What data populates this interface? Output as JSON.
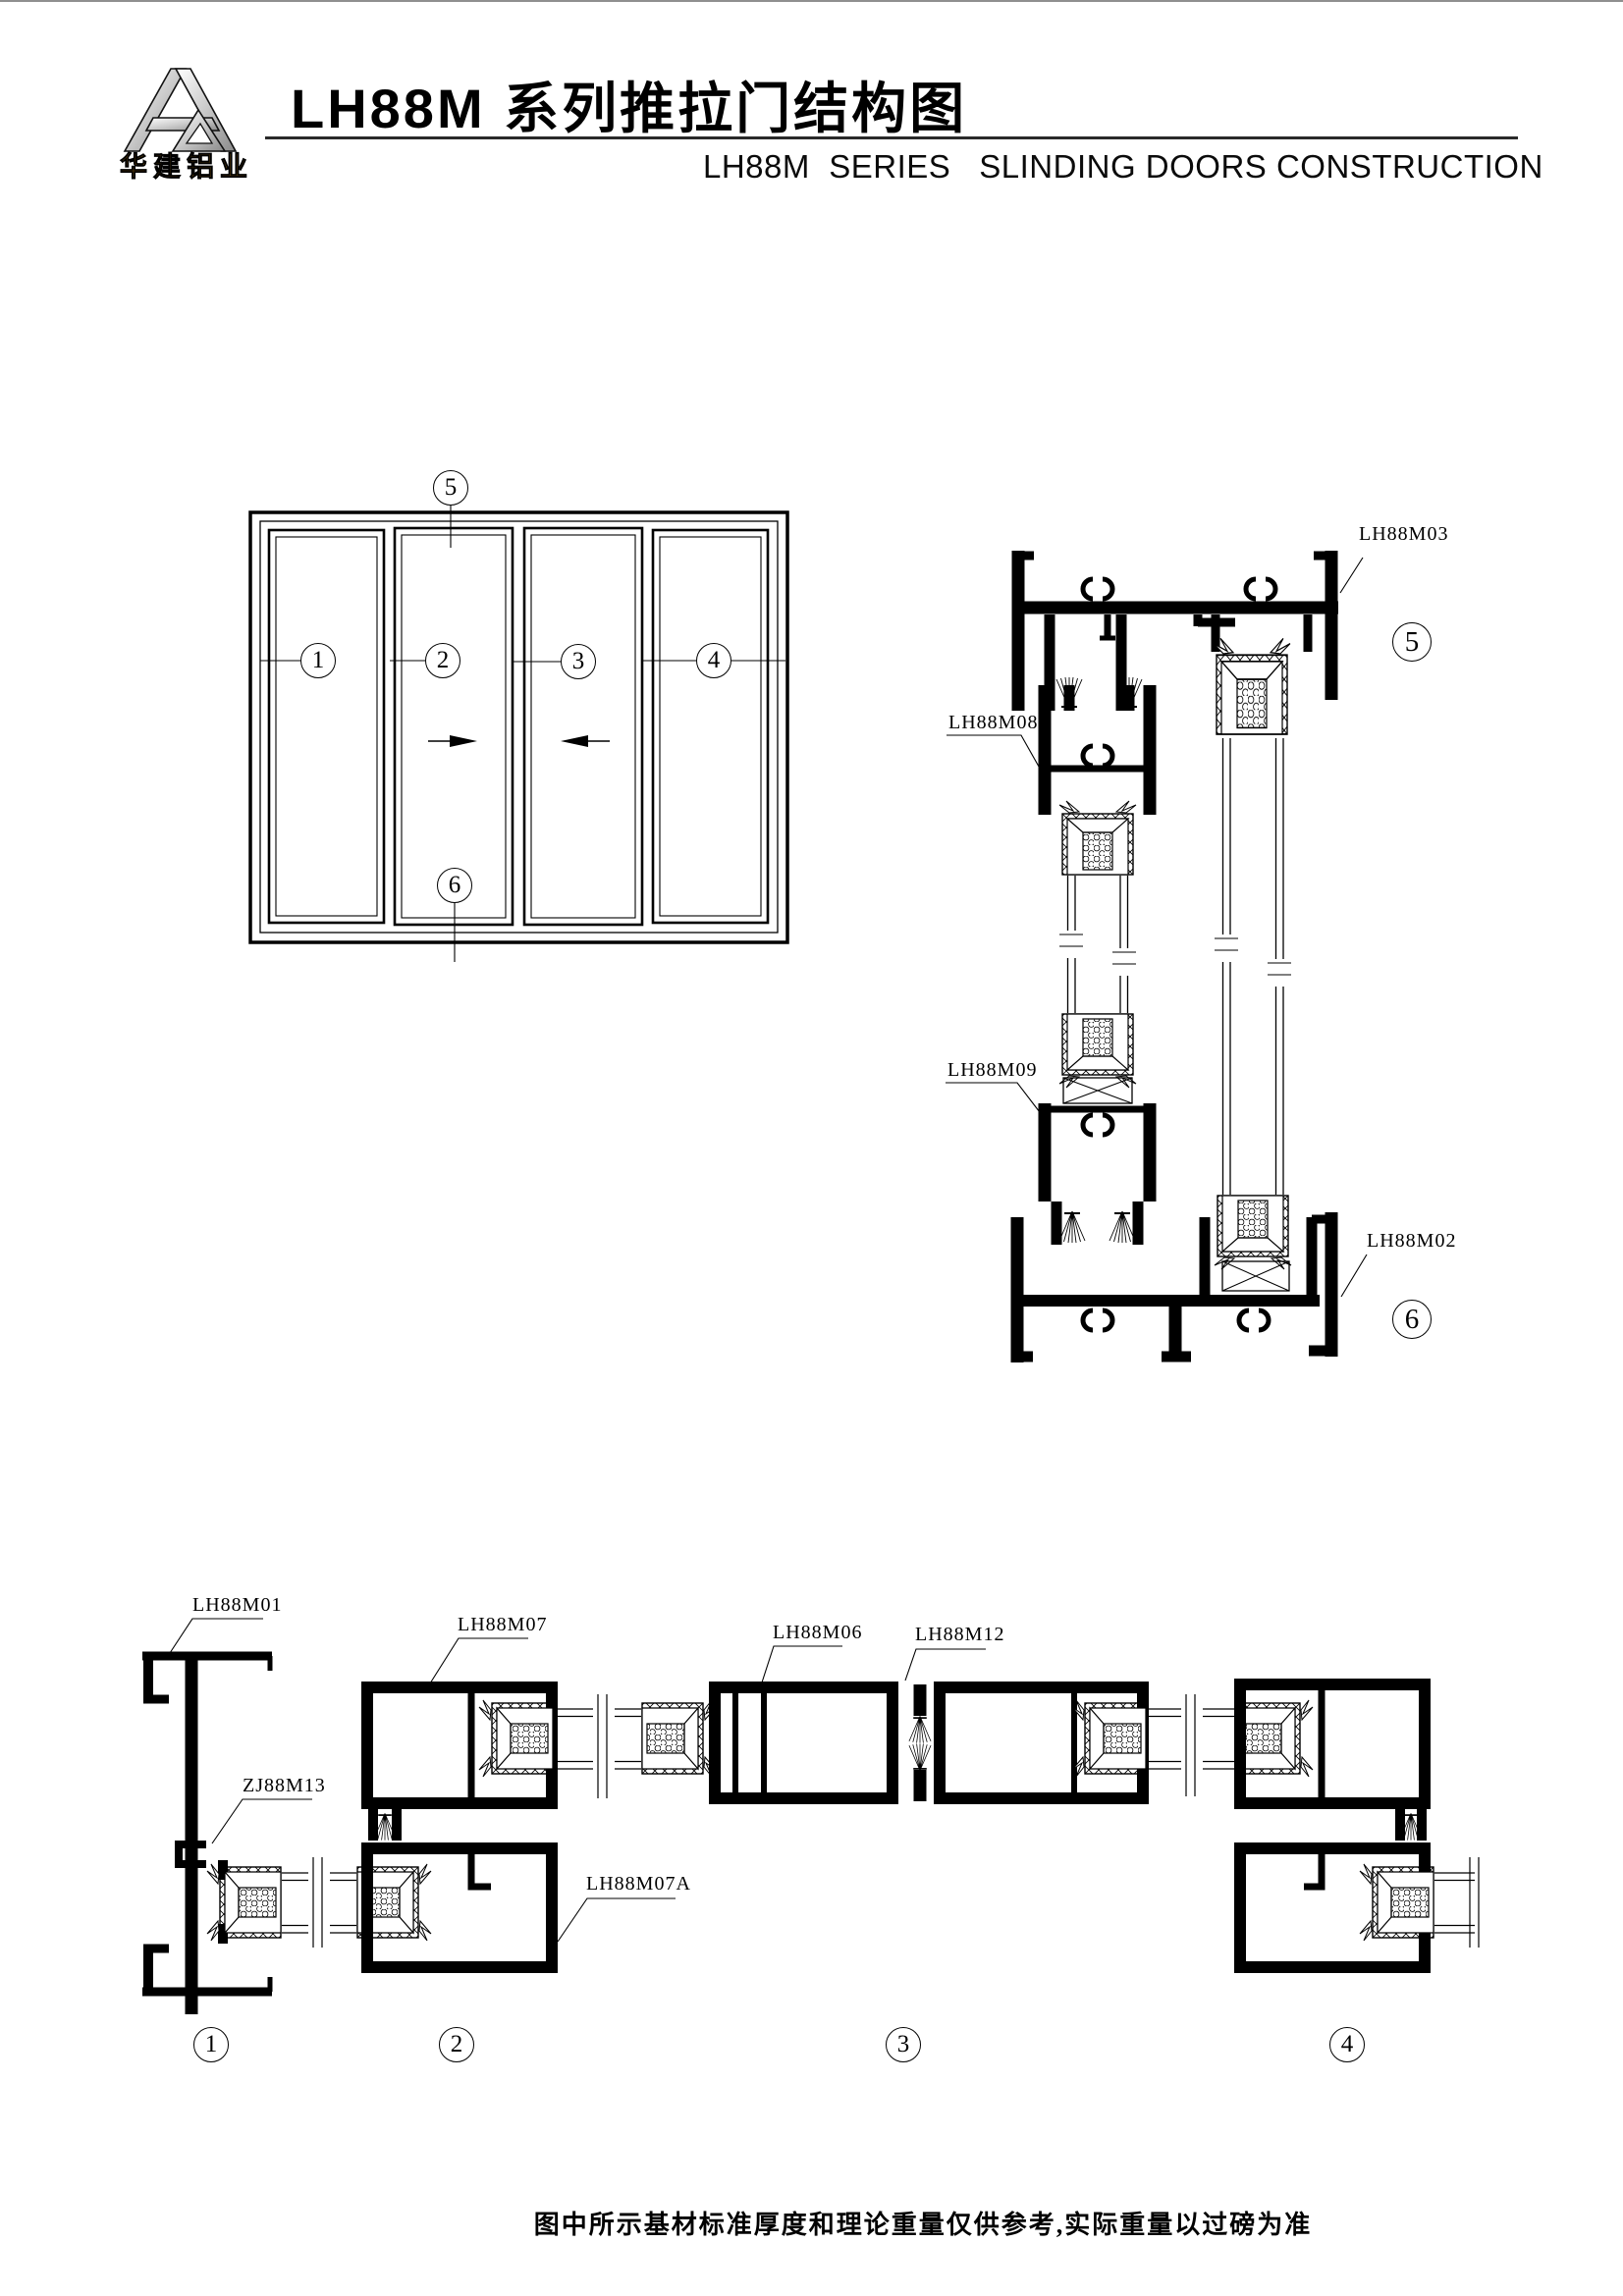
{
  "page": {
    "bg": "#ffffff",
    "top_rule_color": "#8f8f8f",
    "line_color": "#000000"
  },
  "header": {
    "logo": {
      "company": "华建铝业",
      "monogram": "HJ",
      "gold": "#b07818",
      "silver_light": "#ffffff",
      "silver_mid": "#c9c9c9",
      "silver_dark": "#8a8a8a"
    },
    "title_cn": "LH88M 系列推拉门结构图",
    "title_en": "LH88M  SERIES   SLINDING DOORS CONSTRUCTION"
  },
  "elevation": {
    "panel_balloons": [
      "1",
      "2",
      "3",
      "4"
    ],
    "head_balloon": "5",
    "sill_balloon": "6"
  },
  "vertical_section": {
    "labels": {
      "head_profile": "LH88M03",
      "top_rail": "LH88M08",
      "mid_rail": "LH88M09",
      "sill_profile": "LH88M02"
    },
    "head_balloon": "5",
    "sill_balloon": "6"
  },
  "horizontal_section": {
    "labels": {
      "jamb": "LH88M01",
      "corner_bracket": "ZJ88M13",
      "stile_upper": "LH88M07",
      "stile_lower": "LH88M07A",
      "mid_frame": "LH88M06",
      "interlock": "LH88M12"
    },
    "balloons": [
      "1",
      "2",
      "3",
      "4"
    ]
  },
  "footer": {
    "note": "图中所示基材标准厚度和理论重量仅供参考,实际重量以过磅为准"
  }
}
